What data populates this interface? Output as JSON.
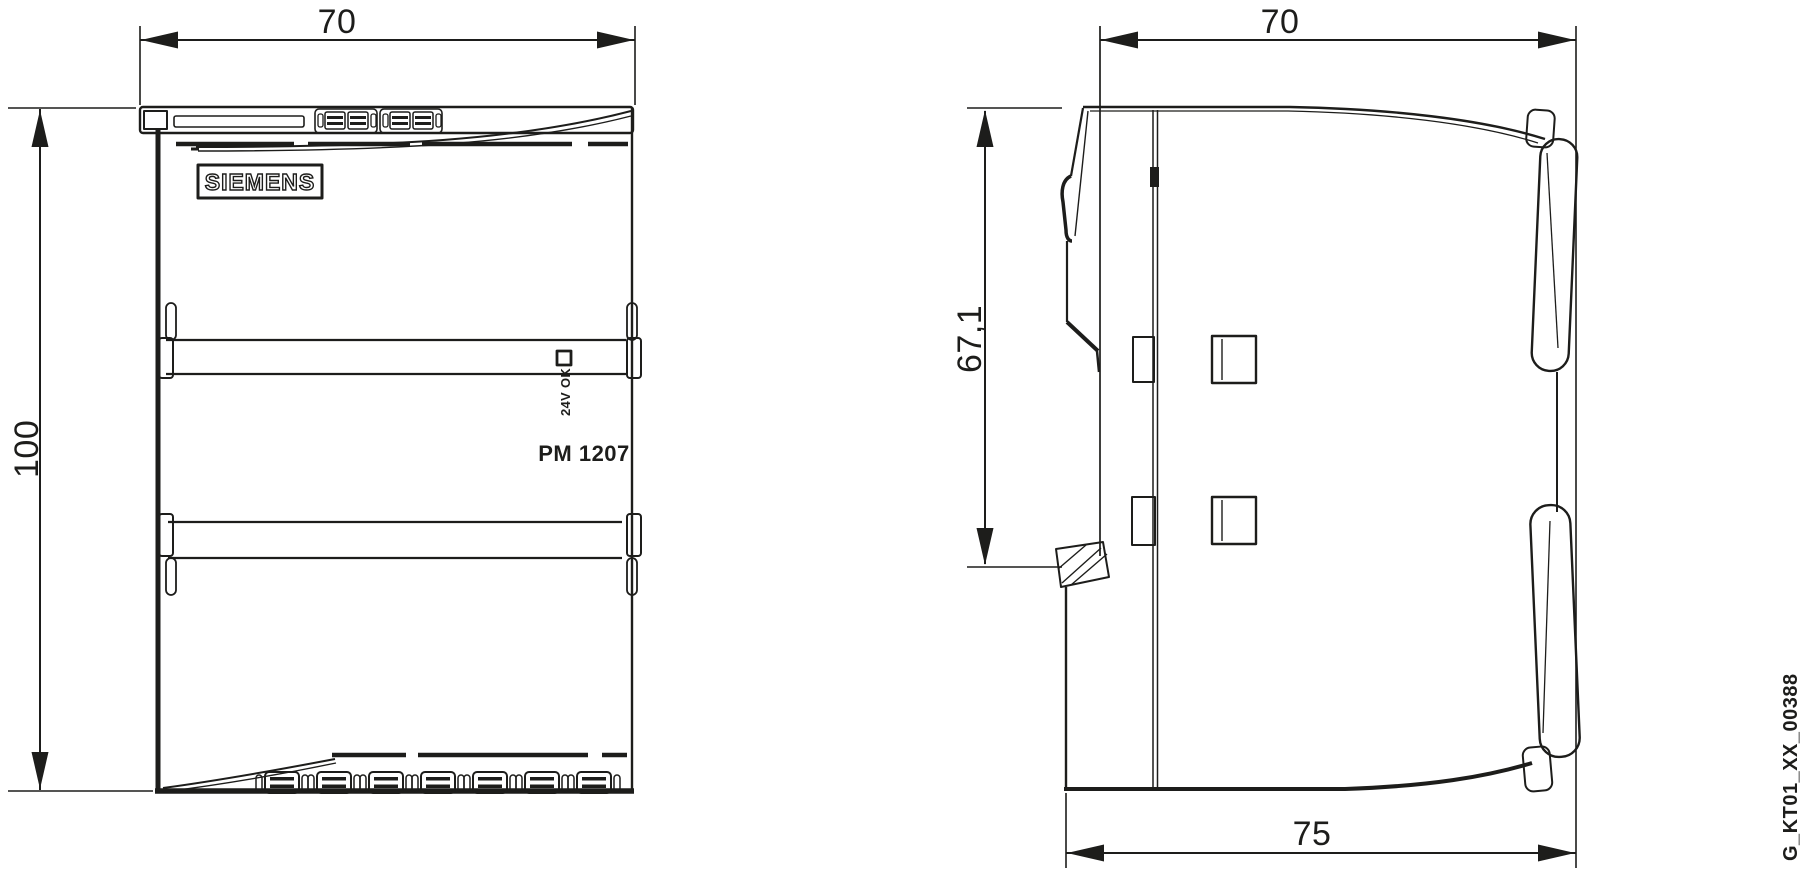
{
  "colors": {
    "line": "#1d1d1b",
    "background": "#ffffff"
  },
  "front_view": {
    "width_dimension": "70",
    "height_dimension": "100",
    "brand_logo": "SIEMENS",
    "led_label": "24V OK",
    "product_label": "PM 1207"
  },
  "side_view": {
    "width_dimension": "70",
    "upper_height_dimension": "67,1",
    "overall_depth_dimension": "75"
  },
  "figure_id": "G_KT01_XX_00388"
}
